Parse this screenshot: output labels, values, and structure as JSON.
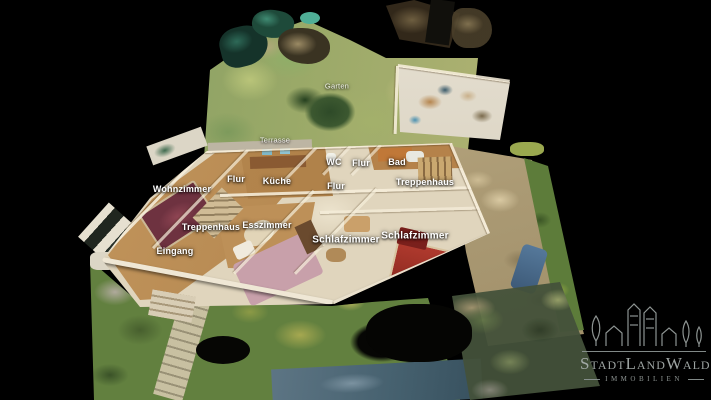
{
  "view": {
    "type_label": "3D-Dollhouse-Ansicht"
  },
  "room_labels": [
    "Garten",
    "Terrasse",
    "WC",
    "Flur",
    "Bad",
    "Flur",
    "Küche",
    "Flur",
    "Treppenhaus",
    "Wohnzimmer",
    "Treppenhaus",
    "Esszimmer",
    "Schlafzimmer",
    "Schlafzimmer",
    "Eingang"
  ],
  "logo": {
    "brand": "StadtLandWald",
    "tagline": "IMMOBILIEN"
  },
  "colors": {
    "background": "#000000",
    "label_text": "#ffffff",
    "logo_gray": "#a7aeac",
    "grass_green": "#7e9a5f",
    "wall_cream": "#e2d7c0",
    "floor_wood": "#c49a62",
    "rug_red": "#a8342a",
    "street_blue": "#5d7584"
  }
}
